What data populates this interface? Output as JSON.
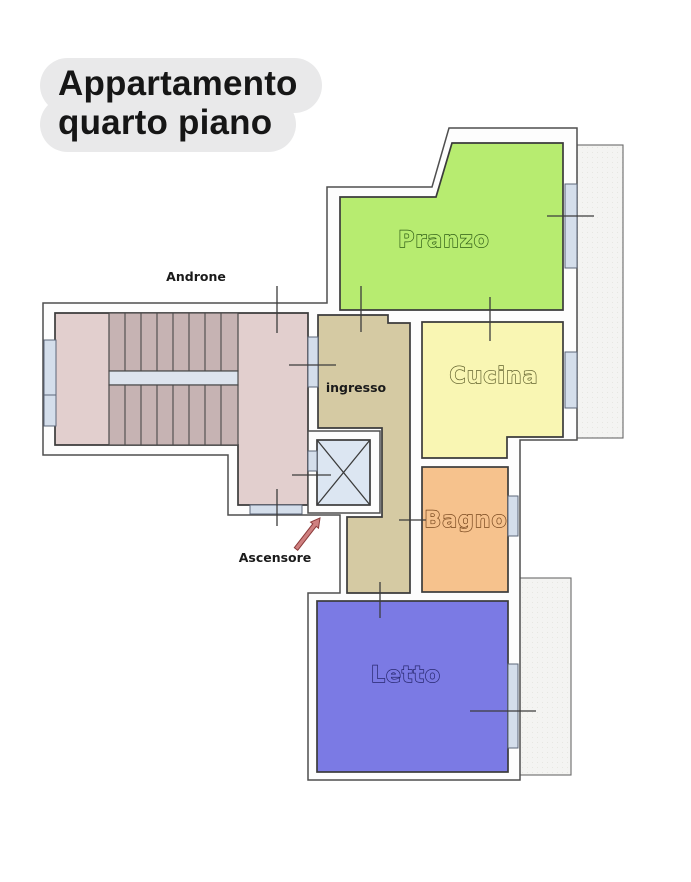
{
  "title": {
    "line1": "Appartamento",
    "line2": "quarto piano"
  },
  "plan": {
    "labels": {
      "androne": "Androne",
      "ingresso": "ingresso",
      "ascensore": "Ascensore",
      "pranzo": "Pranzo",
      "cucina": "Cucina",
      "bagno": "Bagno",
      "letto": "Letto"
    },
    "colors": {
      "background": "#ffffff",
      "wall_fill": "#fdfdfd",
      "wall_line": "#4f4f4f",
      "pranzo": "#b7ec70",
      "cucina": "#f9f6b3",
      "bagno": "#f6c28d",
      "letto": "#7b7ae4",
      "ingresso": "#d5caa3",
      "stairs_floor": "#e2cfce",
      "stairs_treads": "#c6b3b3",
      "landing_strip": "#dde4ee",
      "window": "#d4deeb",
      "elevator": "#dce6f2",
      "balcony": "#f4f4f2",
      "arrow": "#cf8080",
      "title_bubble": "#e9e9ea",
      "title_text": "#161616"
    }
  }
}
